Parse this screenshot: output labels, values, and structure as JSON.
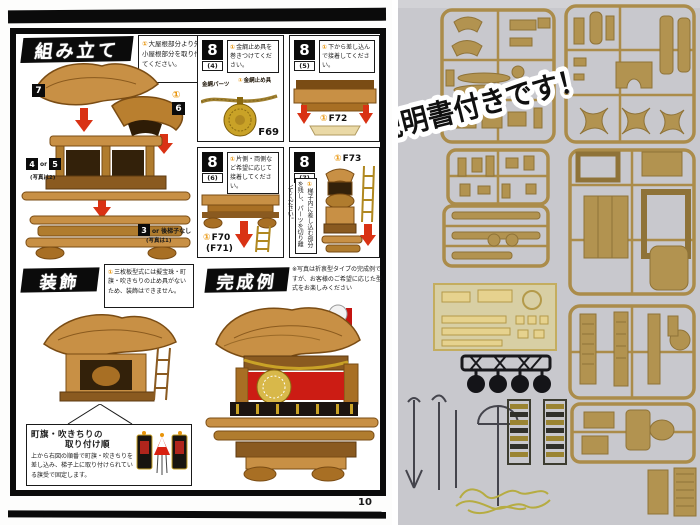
{
  "page_number": "10",
  "marker": "①",
  "assembly": {
    "title": "組み立て",
    "note": "大屋根部分より先に小屋根部分を取り付けてください。",
    "badge_7": "7",
    "badge_1": "①",
    "badge_6": "6",
    "badge_4": "4",
    "badge_or": "or",
    "badge_5": "5",
    "photo_is_2": "(写真は2)",
    "badge_3": "3",
    "badge_3_suffix": "or 後梯子なし",
    "photo_is_1": "(写真は1)"
  },
  "panels": {
    "p4": {
      "num": "8",
      "sub": "(4)",
      "note": "金綱止め具を巻きつけてください。",
      "label_rope": "金綱パーツ",
      "label_stop": "金綱止め具",
      "part": "F69"
    },
    "p5": {
      "num": "8",
      "sub": "(5)",
      "note": "下から差し込んで接着してください。",
      "part": "F72"
    },
    "p6": {
      "num": "8",
      "sub": "(6)",
      "note": "片側・両側など希望に応じて接着してください。",
      "part": "F70",
      "part2": "(F71)"
    },
    "p7": {
      "num": "8",
      "sub": "(7)",
      "note": "梯子内に差し込む部分を残し、パーツを切り離してください。",
      "part": "F73"
    }
  },
  "decoration": {
    "title": "装飾",
    "note": "三枚板型式には擬宝珠・町旗・吹きちりの止め具がないため、装飾はできません。",
    "attach_title_line1": "町旗・吹きちりの",
    "attach_title_line2": "取り付け順",
    "attach_body": "上から右図の順番で町旗・吹きちりを差し込み、梯子上に取り付けられている旗受で固定します。"
  },
  "completed": {
    "title": "完成例",
    "note": "※写真は折衷型タイプの完成例ですが、お客様のご希望に応じた型式をお楽しみください"
  },
  "photo": {
    "caption": "詳しい説明書付きです！"
  },
  "colors": {
    "arrow_red": "#d93214",
    "wood": "#c89045",
    "gold_part": "#c9a227",
    "photo_bg": "#c8c8cd",
    "sprue": "#ab8c4a",
    "marker_orange": "#e8940a"
  }
}
